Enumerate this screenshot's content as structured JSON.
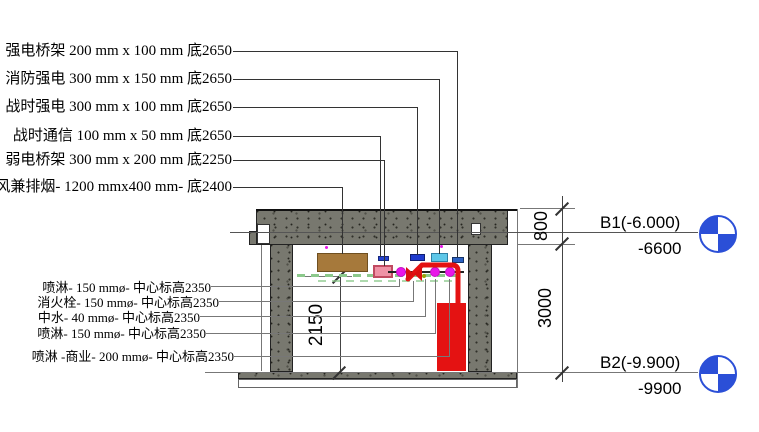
{
  "drawing": {
    "title_hint": "basement corridor pipe and cable-tray section",
    "top_annotations": [
      "强电桥架 200 mm x 100 mm 底2650",
      "消防强电 300 mm x 150 mm 底2650",
      "战时强电 300 mm x 100 mm 底2650",
      "战时通信 100 mm x 50 mm 底2650",
      "弱电桥架 300 mm x 200 mm 底2250",
      "排风兼排烟- 1200 mmx400 mm- 底2400"
    ],
    "bottom_annotations": [
      "喷淋- 150 mmø- 中心标高2350",
      "消火栓- 150 mmø- 中心标高2350",
      "中水- 40 mmø- 中心标高2350",
      "喷淋- 150 mmø- 中心标高2350",
      "喷淋 -商业- 200 mmø- 中心标高2350"
    ],
    "levels": {
      "b1": {
        "label": "B1(-6.000)",
        "elevation": "-6600"
      },
      "b2": {
        "label": "B2(-9.900)",
        "elevation": "-9900"
      }
    },
    "dimensions": {
      "slab_depth": "800",
      "storey_height": "3000",
      "pipe_center_height": "2150"
    },
    "colors": {
      "concrete": "#78786f",
      "fire_pipe_red": "#e41212",
      "sprinkler_magenta": "#e816e8",
      "duct_brown": "#a6793b",
      "tray_pink": "#ef92a6",
      "tray_blue_dark": "#1f3bce",
      "tray_blue_light": "#5ec7e8",
      "tray_blue_mid": "#2c62c4",
      "comm_bar_blue": "#2443cf",
      "level_marker_blue": "#2b4fd7",
      "green_dash": "#8cc98c"
    }
  }
}
